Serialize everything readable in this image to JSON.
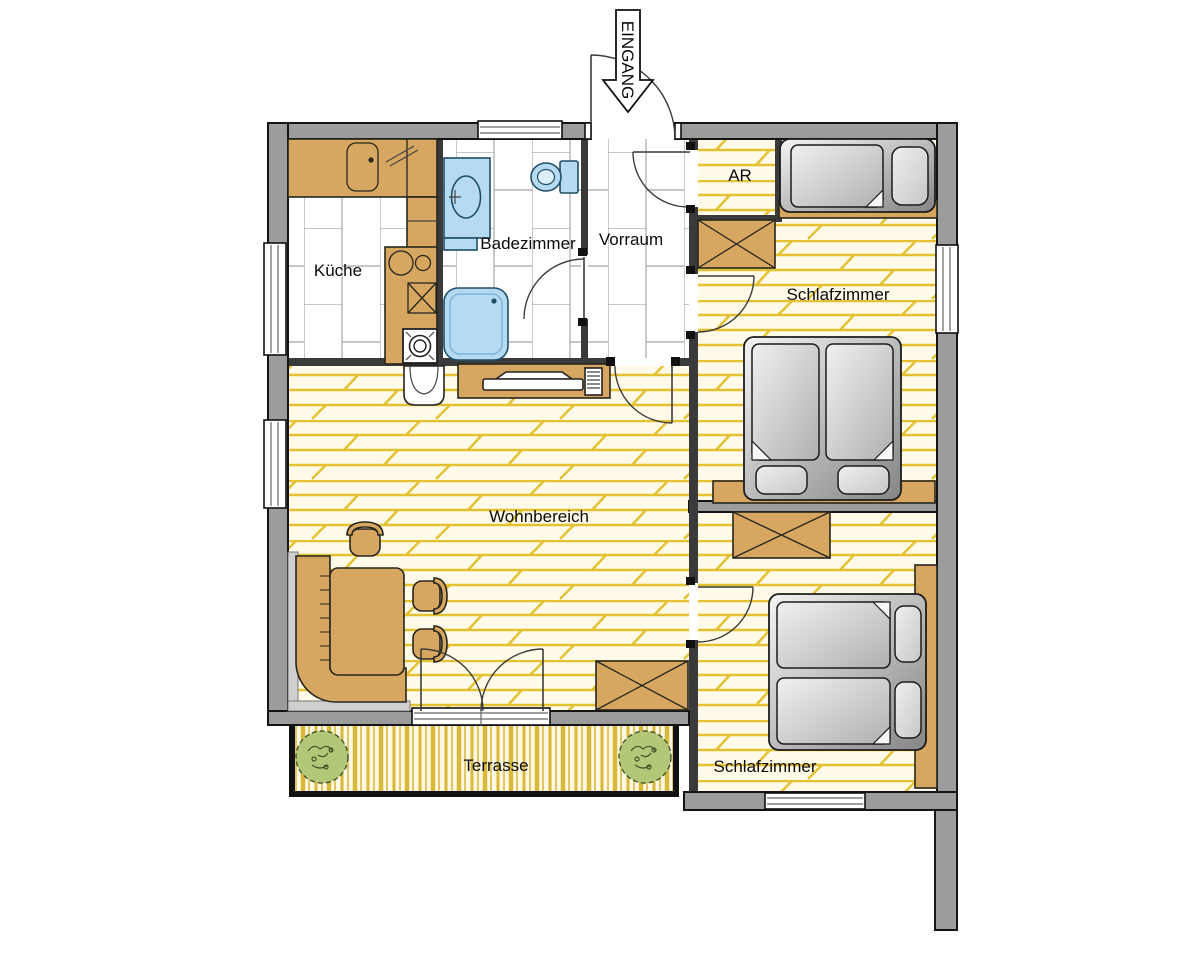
{
  "labels": {
    "kueche": "Küche",
    "badezimmer": "Badezimmer",
    "vorraum": "Vorraum",
    "abstellraum": "AR",
    "schlafzimmer_oben": "Schlafzimmer",
    "wohnbereich": "Wohnbereich",
    "schlafzimmer_unten": "Schlafzimmer",
    "terrasse": "Terrasse",
    "eingang": "EINGANG"
  },
  "colors": {
    "wall": "#9c9c9c",
    "wall_outline": "#141414",
    "interior_wall": "#3a3a3a",
    "furniture": "#d7a761",
    "fixture_blue": "#b5daf1",
    "parquet_bg": "#fffbe8",
    "parquet_line": "#e3c131",
    "tile_line": "#b3b3b3",
    "deck_bg": "#fdf8e3",
    "deck_line": "#d9b93a",
    "plant_green": "#b2c878",
    "plant_outline": "#44552b"
  }
}
